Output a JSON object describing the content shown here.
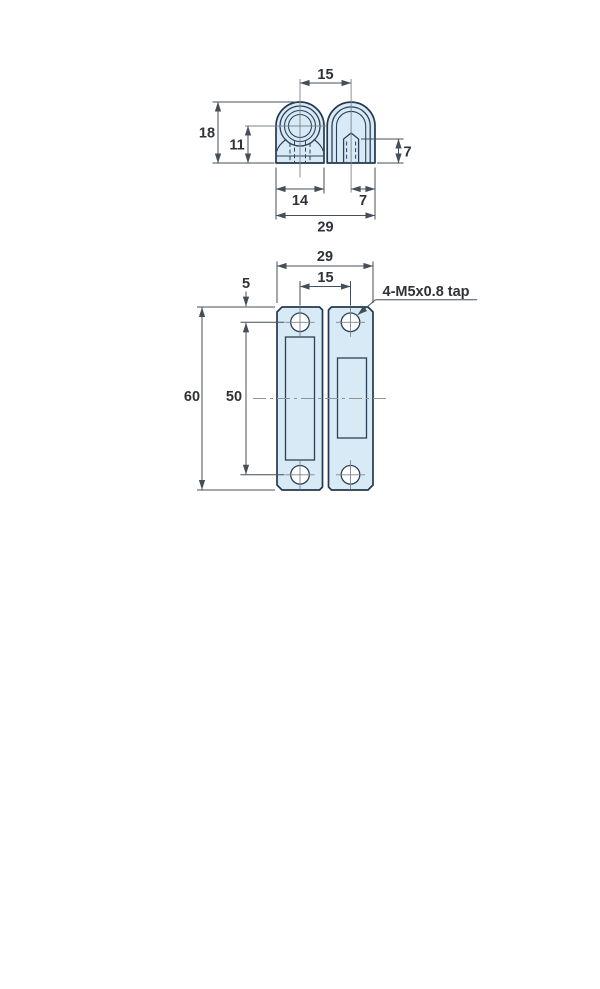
{
  "canvas": {
    "width": 600,
    "height": 989,
    "background": "#ffffff"
  },
  "drawing": {
    "type": "technical-drawing",
    "subject": "two-leaf catch plate with tapped holes, two orthographic views",
    "palette": {
      "part_fill": "#d8eaf6",
      "part_outline": "#24384e",
      "dimension_lines": "#454f59",
      "label_text": "#2e3338",
      "center_lines": "#8d949c"
    },
    "top_view": {
      "name": "end view",
      "labels": {
        "pin_to_tap_spacing": "15",
        "overall_height": "18",
        "center_to_base": "11",
        "tap_depth": "7",
        "left_leaf_width": "14",
        "tap_to_edge": "7",
        "overall_width": "29"
      }
    },
    "front_view": {
      "name": "front view",
      "labels": {
        "overall_width": "29",
        "hole_spacing_horizontal": "15",
        "edge_to_hole": "5",
        "overall_height": "60",
        "hole_spacing_vertical": "50",
        "tap_note": "4-M5x0.8 tap"
      }
    }
  }
}
